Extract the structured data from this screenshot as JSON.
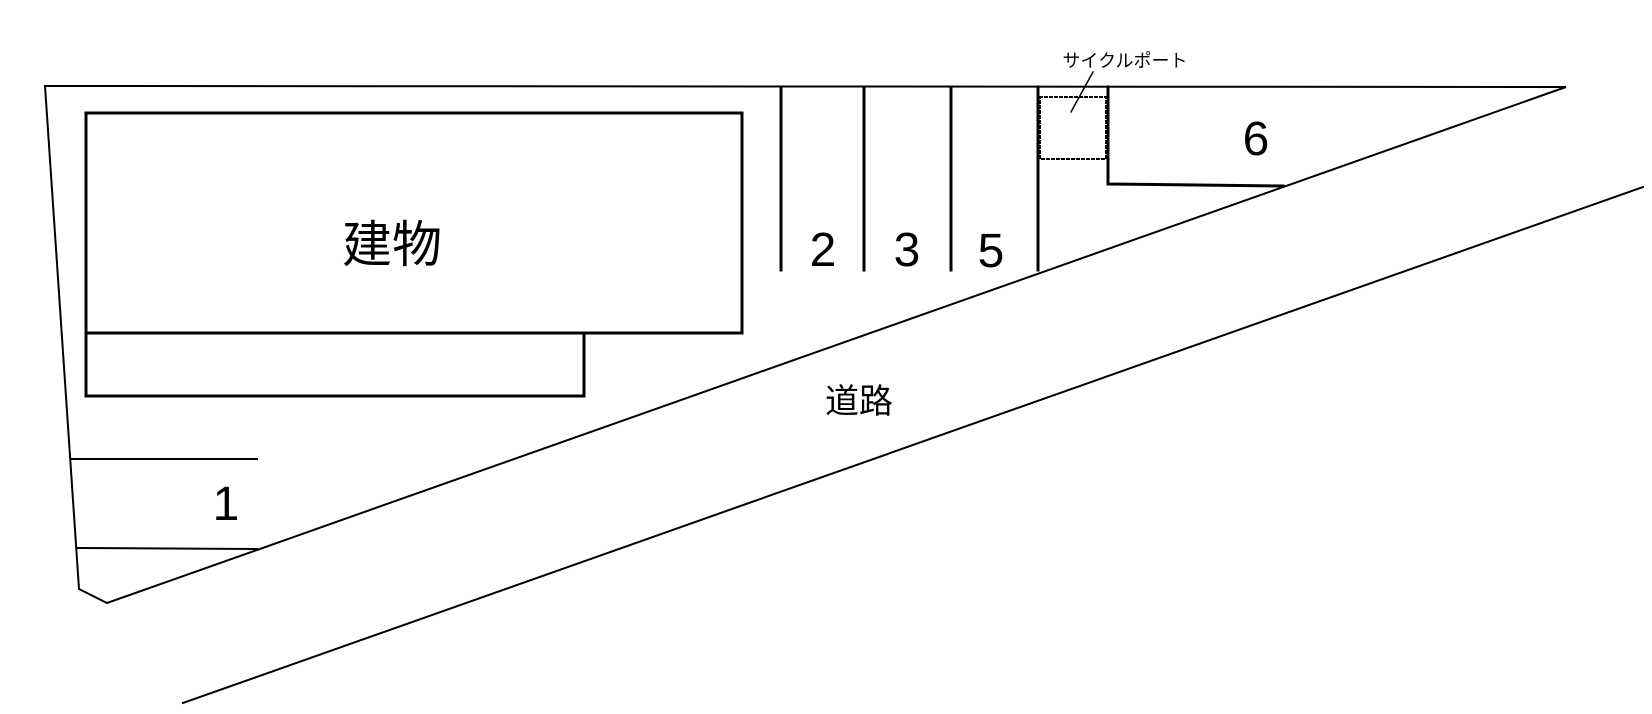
{
  "diagram": {
    "type": "parking-site-plan",
    "background_color": "#ffffff",
    "line_color": "#000000",
    "labels": {
      "building": "建物",
      "road": "道路",
      "cycle_port": "サイクルポート",
      "space_1": "1",
      "space_2": "2",
      "space_3": "3",
      "space_5": "5",
      "space_6": "6"
    },
    "parking_space_numbers": [
      "1",
      "2",
      "3",
      "5",
      "6"
    ]
  }
}
